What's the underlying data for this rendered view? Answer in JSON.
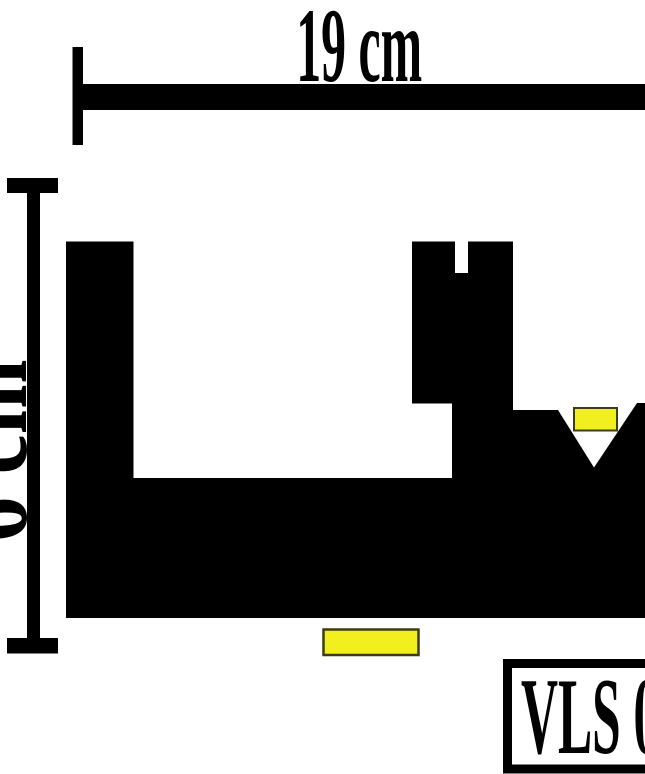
{
  "diagram": {
    "background_color": "#ffffff",
    "ink_color": "#000000",
    "horizontal_dimension": {
      "label": "19 cm"
    },
    "vertical_dimension": {
      "label": "6 cm"
    },
    "caption": {
      "label": "VLS 0"
    },
    "highlights": {
      "fill_color": "#f2ef1f",
      "border_color": "#3d3d12"
    }
  }
}
